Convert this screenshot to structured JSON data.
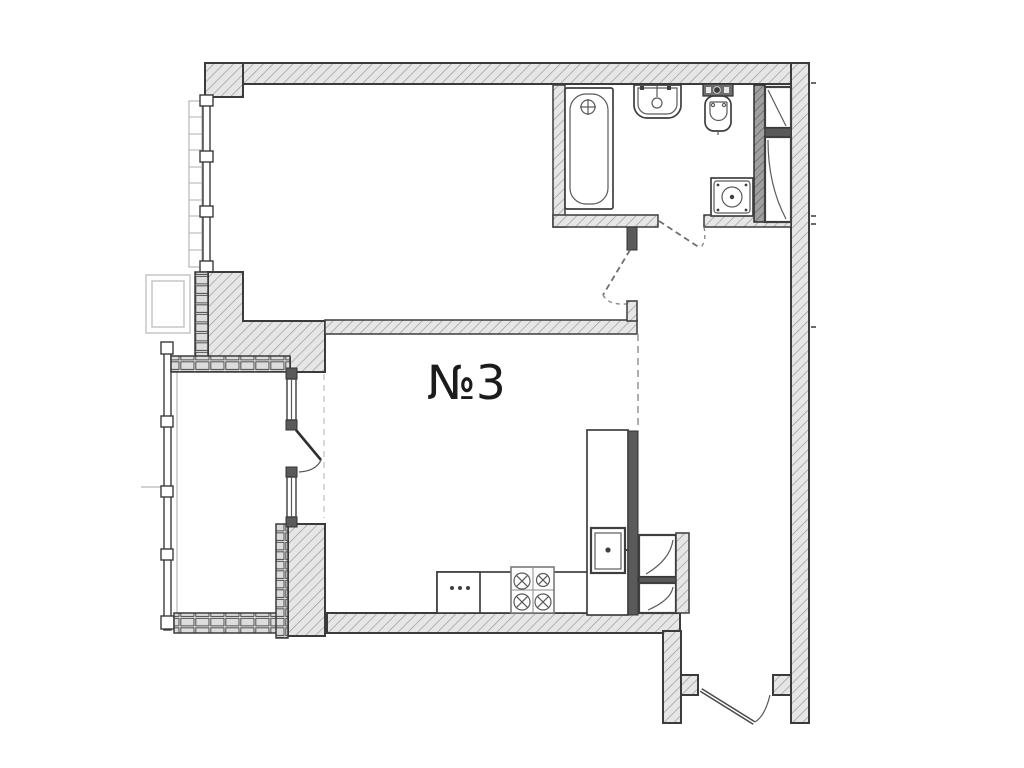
{
  "plan": {
    "unit_label": "№3",
    "drawing_type": "apartment-floor-plan",
    "colors": {
      "background": "#ffffff",
      "line": "#3b3b3b",
      "wall_fill": "#e6e6e6",
      "hatch_line": "#9c9c9c",
      "dark_fill": "#5a5a5a"
    },
    "fixture_icons": [
      "bathtub-icon",
      "washbasin-icon",
      "toilet-icon",
      "washing-machine-icon",
      "kitchen-sink-icon",
      "stove-icon",
      "kitchen-cabinet-icon",
      "vent-shaft-icon",
      "balcony-glazing-icon",
      "entry-door-icon"
    ]
  }
}
